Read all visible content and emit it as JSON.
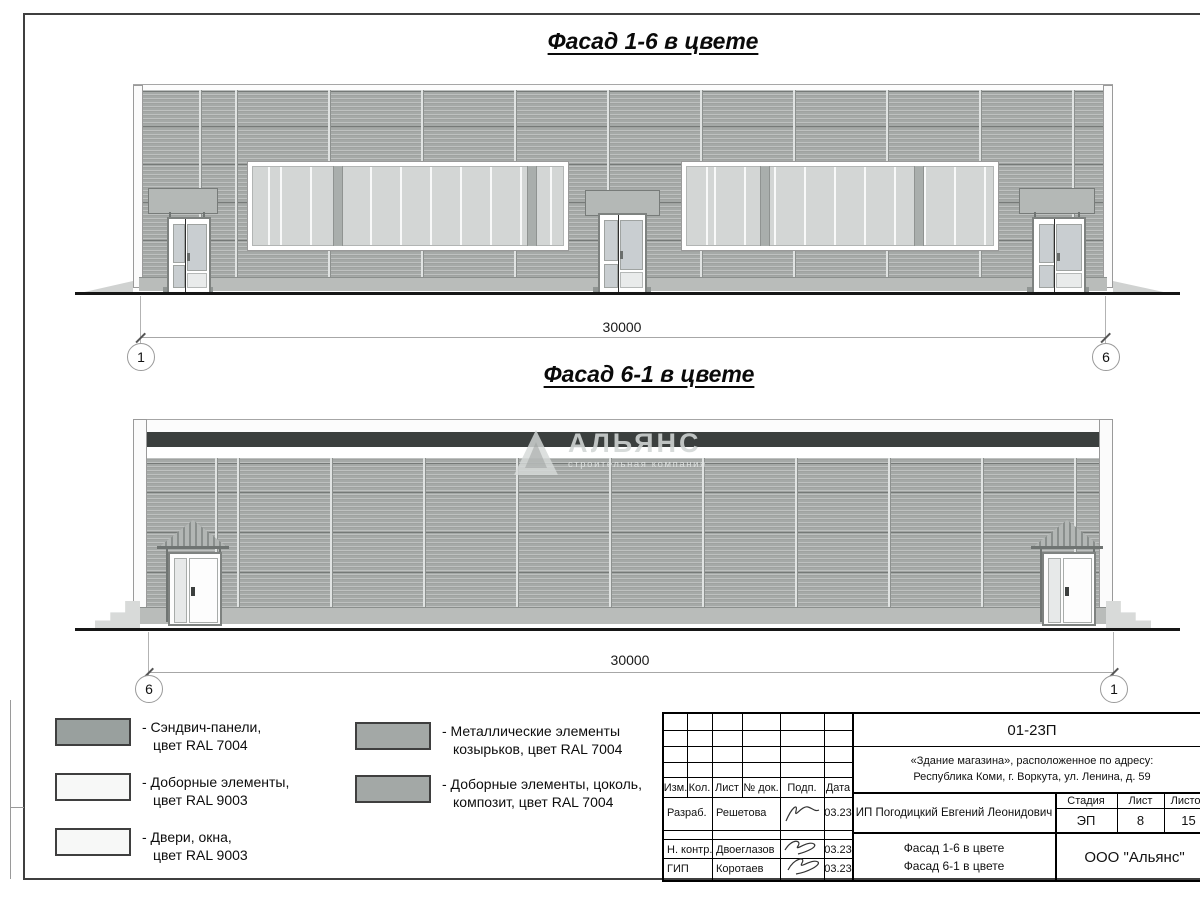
{
  "page": {
    "title1": "Фасад 1-6 в цвете",
    "title2": "Фасад 6-1 в цвете"
  },
  "facade1": {
    "dim": "30000",
    "axis_left": "1",
    "axis_right": "6"
  },
  "facade2": {
    "dim": "30000",
    "axis_left": "6",
    "axis_right": "1"
  },
  "watermark": {
    "name": "АЛЬЯНС",
    "tagline": "строительная компания"
  },
  "legend": [
    {
      "l1": "- Сэндвич-панели,",
      "l2": "цвет RAL 7004",
      "color": "#99a09e"
    },
    {
      "l1": "- Доборные элементы,",
      "l2": "цвет RAL 9003",
      "color": "#f7f8f7"
    },
    {
      "l1": "- Двери, окна,",
      "l2": "цвет RAL 9003",
      "color": "#f7f8f7"
    },
    {
      "l1": "- Металлические элементы",
      "l2": "козырьков, цвет RAL 7004",
      "color": "#a3a8a6"
    },
    {
      "l1": "- Доборные элементы, цоколь,",
      "l2": "композит, цвет RAL 7004",
      "color": "#a3a8a6"
    }
  ],
  "stamp": {
    "code": "01-23П",
    "address1": "«Здание магазина», расположенное по адресу:",
    "address2": "Республика Коми, г. Воркута, ул. Ленина, д. 59",
    "col_izm": "Изм.",
    "col_kol": "Кол.",
    "col_list": "Лист",
    "col_ndok": "№ док.",
    "col_podp": "Подп.",
    "col_data": "Дата",
    "row1_role": "Разраб.",
    "row1_name": "Решетова",
    "row1_date": "03.23",
    "row2_role": "Н. контр.",
    "row2_name": "Двоеглазов",
    "row2_date": "03.23",
    "row3_role": "ГИП",
    "row3_name": "Коротаев",
    "row3_date": "03.23",
    "client": "ИП Погодицкий Евгений Леонидович",
    "stage_h": "Стадия",
    "list_h": "Лист",
    "listov_h": "Листов",
    "stage_v": "ЭП",
    "list_v": "8",
    "listov_v": "15",
    "dt1": "Фасад 1-6 в цвете",
    "dt2": "Фасад 6-1 в цвете",
    "org": "ООО \"Альянс\""
  },
  "colors": {
    "panel_ral7004": "#a5a9a7",
    "trim_ral9003": "#fbfbfb",
    "dark_parapet": "#3b3f3e",
    "canopy": "#b4b8b6",
    "glazing": "#c9ced1"
  }
}
